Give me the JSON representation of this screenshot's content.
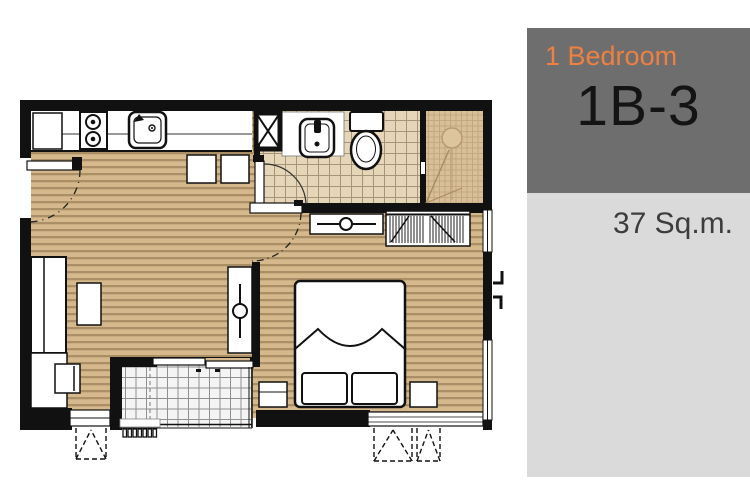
{
  "panel": {
    "unit_type": "1 Bedroom",
    "unit_code": "1B-3",
    "unit_area": "37 Sq.m."
  },
  "colors": {
    "panel_header_bg": "#6e6e6e",
    "panel_body_bg": "#dadada",
    "unit_type_color": "#ef8040",
    "unit_code_color": "#141414",
    "unit_area_color": "#3d3d3d",
    "wall": "#111111",
    "wood_floor": "#d5b88b",
    "wood_floor_line": "#aa8f66",
    "bath_tile": "#e6d6b8",
    "bath_tile_line": "#a8947a",
    "shower_tile": "#d9bf97",
    "shower_tile_line": "#bda379",
    "balcony_tile": "#f4f4f4",
    "balcony_tile_line": "#909090"
  },
  "floor_plan": {
    "fixtures": [
      "entry-door",
      "kitchen-counter",
      "fridge",
      "stove",
      "kitchen-sink",
      "dining-stools",
      "service-shaft",
      "washbasin",
      "toilet",
      "shower",
      "shower-drain",
      "bathroom-door",
      "bedroom-door",
      "wardrobe",
      "dresser",
      "double-bed",
      "pillows",
      "nightstand-left",
      "nightstand-right",
      "dressing-table",
      "sofa",
      "coffee-table",
      "tv-cabinet",
      "tv",
      "balcony",
      "sliding-door",
      "ac-louver",
      "window-left",
      "window-bedroom",
      "window-right-wall",
      "casement-symbols",
      "window-hooks"
    ]
  }
}
